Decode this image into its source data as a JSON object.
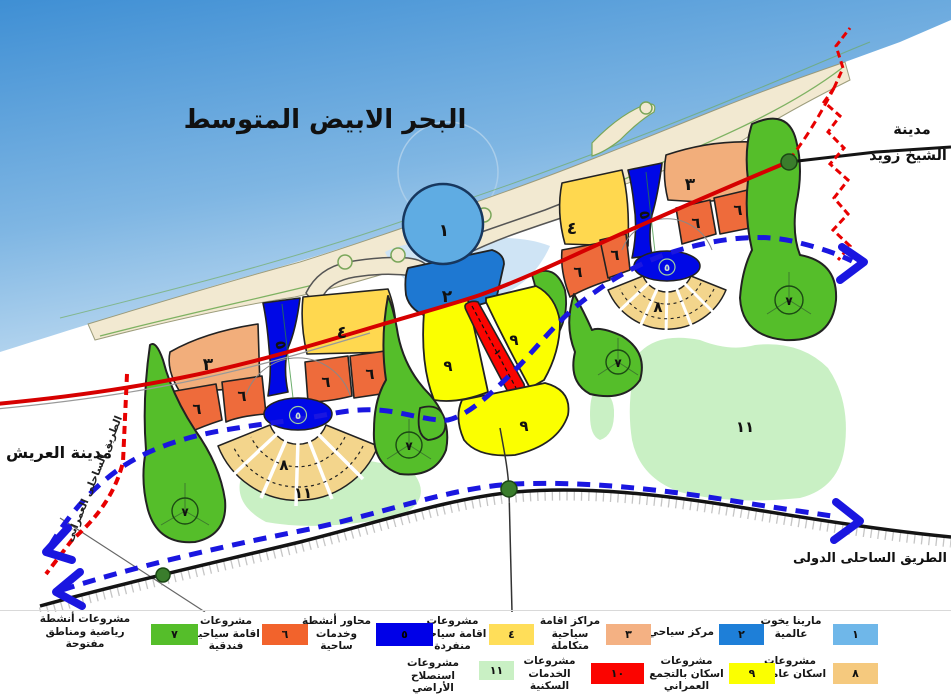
{
  "title": "البحر الابيض المتوسط",
  "labels": {
    "city_west": "مدينة العريش",
    "city_east_1": "مدينة",
    "city_east_2": "الشيخ زويد",
    "road_international": "الطريق الساحلى الدولى",
    "road_urban": "الطريق الساحلى العمرانى"
  },
  "nums": {
    "n1": "١",
    "n2": "٢",
    "n3": "٣",
    "n4": "٤",
    "n5": "٥",
    "n6": "٦",
    "n7": "٧",
    "n8": "٨",
    "n9": "٩",
    "n10": "١٠",
    "n11": "١١"
  },
  "legend": {
    "row1": [
      {
        "num": "١",
        "label": "مارينا يخوت عالمية",
        "color": "#6FB7E9"
      },
      {
        "num": "٢",
        "label": "مركز سياحي",
        "color": "#1E7FD8"
      },
      {
        "num": "٣",
        "label": "مراكز اقامة سياحية متكاملة",
        "color": "#F4B183"
      },
      {
        "num": "٤",
        "label": "مشروعات اقامة سياحية منفردة",
        "color": "#FFDE59"
      },
      {
        "num": "٥",
        "label": "محاور أنشطة وخدمات ساحية",
        "color": "#0000E8"
      },
      {
        "num": "٦",
        "label": "مشروعات اقامة سياحية فندقية",
        "color": "#F2632C"
      },
      {
        "num": "٧",
        "label": "مشروعات أنشطة رياضية ومناطق مفتوحة",
        "color": "#55BE2A"
      }
    ],
    "row2": [
      {
        "num": "٨",
        "label": "مشروعات اسكان عاملين",
        "color": "#F5C97E"
      },
      {
        "num": "٩",
        "label": "مشروعات اسكان بالتجمع العمراني",
        "color": "#FBFF00"
      },
      {
        "num": "١٠",
        "label": "مشروعات الخدمات السكنية",
        "color": "#FB0400"
      },
      {
        "num": "١١",
        "label": "مشروعات استصلاح الأراضي",
        "color": "#C9F0C4"
      }
    ]
  },
  "colors": {
    "sea_top": "#3F8FD4",
    "sea_shore": "#C9E0F2",
    "beach": "#F2E9D0",
    "green_7": "#55BE2A",
    "light_green_11": "#C9F0C4",
    "salmon_3": "#F2AE7B",
    "orange_6": "#EE6B3B",
    "dark_blue_5": "#0008E6",
    "gold_4": "#FFD84F",
    "yellow_9": "#FBFF00",
    "red_10": "#FB0400",
    "tan_8": "#F3D58C",
    "blue_2": "#1E78D2",
    "light_blue_1": "#5FACE3",
    "road_red": "#D60000",
    "road_blue_dashed": "#1A16E0",
    "road_black": "#141414",
    "boundary_red_dashed": "#E80000",
    "node_green": "#3A7D2C"
  }
}
